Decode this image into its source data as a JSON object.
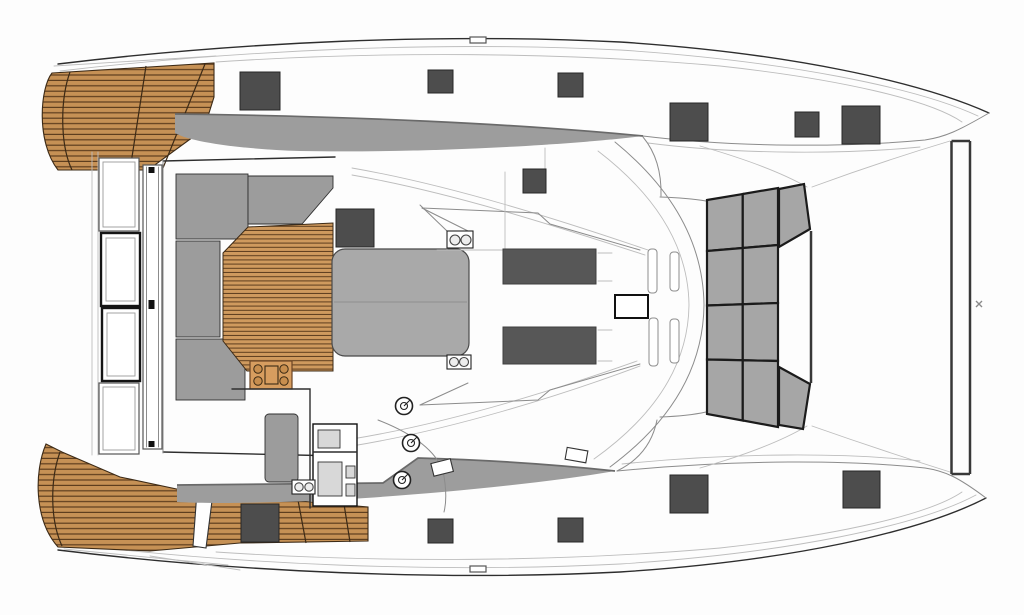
{
  "meta": {
    "label": "Sailing catamaran deck plan, top view, bow to the right"
  },
  "palette": {
    "background": "#fdfdfd",
    "hull_line": "#2e2e2e",
    "mid_line": "#8c8c8c",
    "light_line": "#bdbdbd",
    "teak_plank": "#c69155",
    "teak_plank_light": "#cf9a5e",
    "teak_gap": "#5d3d1e",
    "teak_edge": "#3c2a16",
    "cushion_gray": "#9c9c9c",
    "walkway_gray": "#9d9d9d",
    "walkway_edge": "#6a6a6a",
    "table_gray": "#a9a9a9",
    "hatch_dark": "#4d4d4d",
    "hatch_stroke": "#262626",
    "skylight_dark": "#575757",
    "trampoline_gray": "#a6a6a6",
    "trampoline_grid": "#1b1b1b",
    "module_wood": "#d79d5f",
    "module_edge": "#6b4423",
    "white": "#ffffff"
  },
  "components": {
    "deck_hatches": [
      [
        240,
        72,
        40,
        38
      ],
      [
        428,
        70,
        25,
        23
      ],
      [
        558,
        73,
        25,
        24
      ],
      [
        670,
        103,
        38,
        38
      ],
      [
        795,
        112,
        24,
        25
      ],
      [
        842,
        106,
        38,
        38
      ],
      [
        523,
        169,
        23,
        24
      ],
      [
        336,
        209,
        38,
        38
      ],
      [
        241,
        504,
        38,
        38
      ],
      [
        428,
        519,
        25,
        24
      ],
      [
        558,
        518,
        25,
        24
      ],
      [
        670,
        475,
        38,
        38
      ],
      [
        843,
        471,
        37,
        37
      ]
    ],
    "skylights": [
      [
        503,
        249,
        93,
        35
      ],
      [
        503,
        327,
        93,
        37
      ]
    ],
    "escape_hatch": [
      615,
      295,
      33,
      23
    ],
    "window_rails": [
      [
        648,
        249,
        9,
        44
      ],
      [
        649,
        318,
        9,
        48
      ],
      [
        670,
        252,
        9,
        39
      ],
      [
        670,
        319,
        9,
        44
      ]
    ],
    "winches": [
      [
        404,
        406
      ],
      [
        411,
        443
      ],
      [
        402,
        480
      ]
    ],
    "trampoline": {
      "x_left": 707,
      "x_mid": 742.75,
      "x_right": 778,
      "left_ys": [
        200,
        251,
        305.5,
        359.5,
        414
      ],
      "right_ys": [
        188,
        245,
        303,
        361,
        427
      ],
      "wedges": [
        [
          779,
          189,
          804,
          184,
          810,
          229,
          779,
          247
        ],
        [
          779,
          367,
          810,
          384,
          803,
          429,
          779,
          425
        ]
      ]
    },
    "bow_beam": {
      "x1": 951.5,
      "x2": 970,
      "y_top": 141,
      "y_bottom": 474
    },
    "forestay_mark": [
      979,
      304
    ]
  }
}
